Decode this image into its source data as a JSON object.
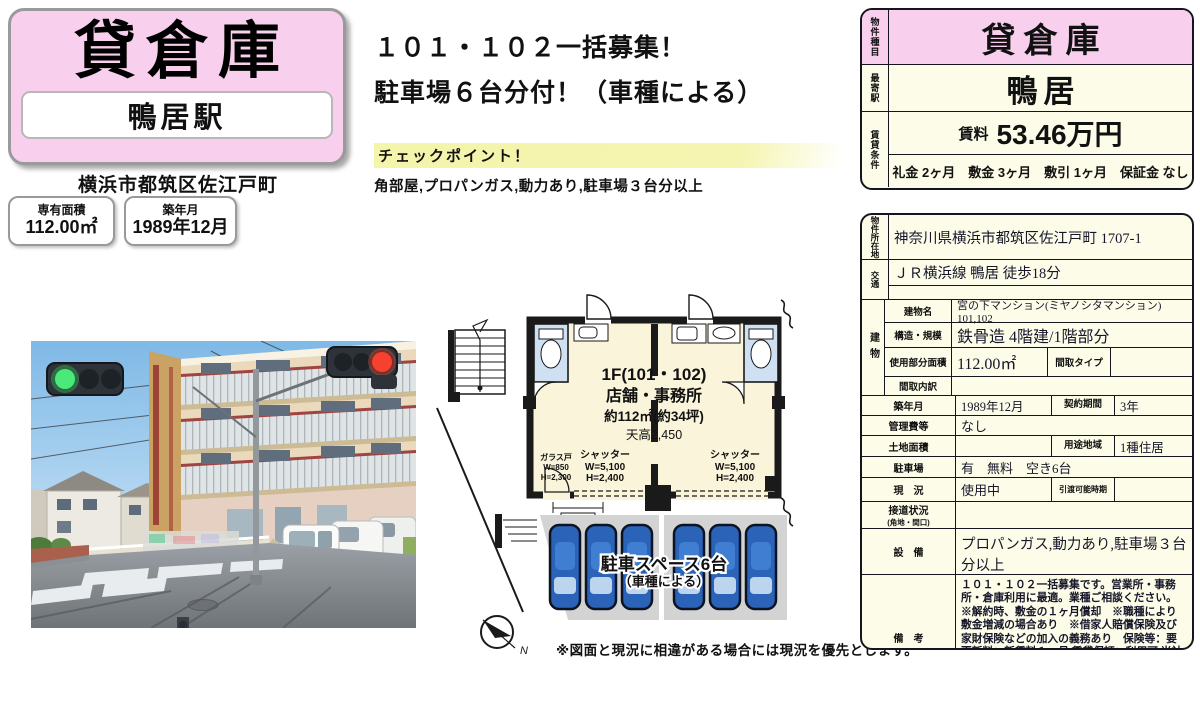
{
  "header": {
    "property_type": "貸倉庫",
    "station": "鴨居駅",
    "address": "横浜市都筑区佐江戸町",
    "area_label": "専有面積",
    "area_value": "112.00㎡",
    "built_label": "築年月",
    "built_value": "1989年12月"
  },
  "headline": {
    "line1": "１０１・１０２一括募集！",
    "line2": "駐車場６台分付！（車種による）",
    "checkpoint_label": "チェックポイント！",
    "checkpoint_text": "角部屋,プロパンガス,動力あり,駐車場３台分以上"
  },
  "floorplan": {
    "title": "1F(101・102)",
    "subtitle": "店舗・事務所",
    "area": "約112㎡(約34坪)",
    "ceiling": "天高2,450",
    "glass_door_label": "ガラス戸",
    "glass_door_w": "W=850",
    "glass_door_h": "H=2,300",
    "shutter_left_label": "シャッター",
    "shutter_left_w": "W=5,100",
    "shutter_left_h": "H=2,400",
    "shutter_right_label": "シャッター",
    "shutter_right_w": "W=5,100",
    "shutter_right_h": "H=2,400",
    "dim_1500": "1500",
    "parking_line1": "駐車スペース6台",
    "parking_line2": "（車種による）",
    "north_label": "N",
    "note": "※図面と現況に相違がある場合には現況を優先とします。"
  },
  "summary": {
    "type_label": "物件種目",
    "type_value": "貸倉庫",
    "station_label": "最寄駅",
    "station_value": "鴨居",
    "terms_label": "賃貸条件",
    "rent_label": "賃料",
    "rent_value": "53.46万円",
    "terms_value": "礼金 2ヶ月　敷金 3ヶ月　敷引 1ヶ月　保証金 なし"
  },
  "details": {
    "location_label": "物件所在地",
    "location": "神奈川県横浜市都筑区佐江戸町 1707-1",
    "access_label": "交通",
    "access": "ＪＲ横浜線 鴨居 徒歩18分",
    "access2": "",
    "building_label": "建物",
    "building_name_label": "建物名",
    "building_name": "宮の下マンション(ミヤノシタマンション)　101,102",
    "structure_label": "構造・規模",
    "structure": "鉄骨造 4階建/1階部分",
    "used_area_label": "使用部分面積",
    "used_area": "112.00㎡",
    "madori_type_label": "間取タイプ",
    "madori_type": "",
    "madori_detail_label": "間取内訳",
    "madori_detail": "",
    "built_label": "築年月",
    "built": "1989年12月",
    "contract_label": "契約期間",
    "contract": "3年",
    "mgmt_label": "管理費等",
    "mgmt": "なし",
    "land_label": "土地面積",
    "land": "",
    "zoning_label": "用途地域",
    "zoning": "1種住居",
    "parking_label": "駐車場",
    "parking": "有　無料　空き6台",
    "status_label": "現　況",
    "status": "使用中",
    "handover_label": "引渡可能時期",
    "handover": "",
    "road_label": "接道状況",
    "road_sub": "(角地・間口)",
    "road": "",
    "equip_label": "設　備",
    "equip": "プロパンガス,動力あり,駐車場３台分以上",
    "remarks_label": "備　考",
    "remarks": "１０１・１０２一括募集です。営業所・事務所・倉庫利用に最適。業種ご相談ください。 ※解約時、敷金の１ヶ月償却　※職種により敷金増減の場合あり　※借家人賠償保険及び家財保険などの加入の義務あり　保険等：要　更新料：新賃料１ヶ月 賃貸保証：利用可 当社指定賃貸保証会社加入の場合あり　駐車場備考：車種により６台駐車可能　利用駅１：横浜市グリーンライン 川和町 徒歩22分"
  }
}
